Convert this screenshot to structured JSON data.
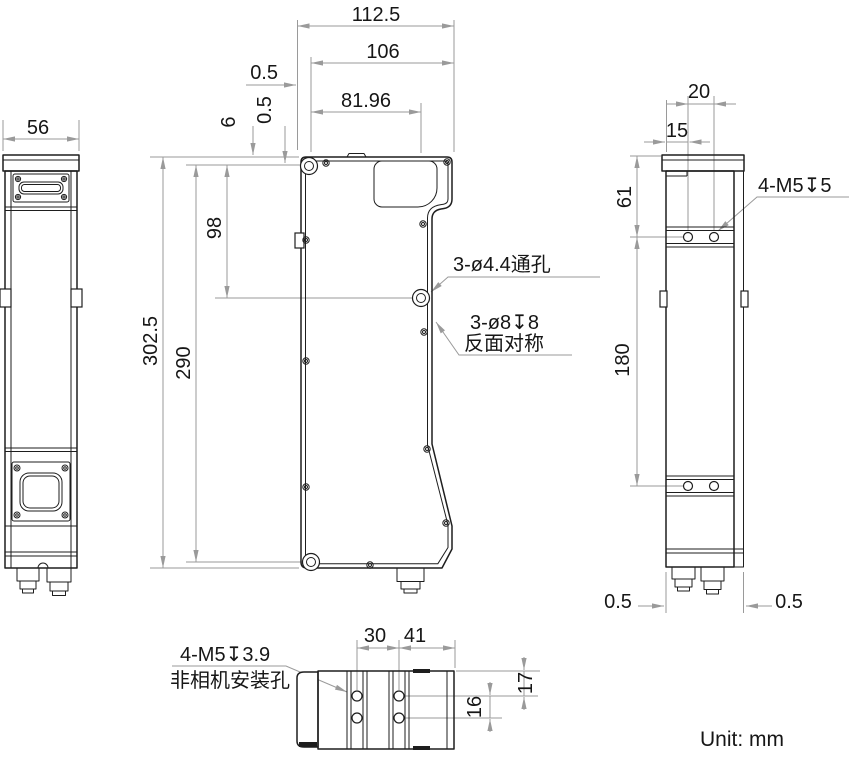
{
  "unit": {
    "label": "Unit: mm"
  },
  "colors": {
    "outline": "#1e1e1e",
    "dimension": "#9a9a9a",
    "background": "#ffffff"
  },
  "left_view": {
    "dim_width": "56"
  },
  "front_view": {
    "dim_total_width": "112.5",
    "dim_body_width": "106",
    "dim_hole_column": "81.96",
    "dim_front_lip": "0.5",
    "dim_top_to_hole": "6",
    "dim_top_small": "0.5",
    "dim_total_height": "302.5",
    "dim_hole_span": "290",
    "dim_top_hole_to_mid_hole": "98",
    "ann_through_holes": "3-ø4.4通孔",
    "ann_counterbore": "3-ø8↧8",
    "ann_counterbore_note": "反面对称"
  },
  "side_view": {
    "dim_hole_spacing": "20",
    "dim_edge_to_hole": "15",
    "dim_top_to_holes": "61",
    "dim_hole_rows_span": "180",
    "dim_gap_left": "0.5",
    "dim_gap_right": "0.5",
    "ann_mount_holes": "4-M5↧5"
  },
  "bottom_view": {
    "dim_rail_spacing": "30",
    "dim_rail_to_edge": "41",
    "dim_edge_to_row": "17",
    "dim_row_spacing": "16",
    "ann_mount_holes": "4-M5↧3.9",
    "ann_mount_note": "非相机安装孔"
  }
}
